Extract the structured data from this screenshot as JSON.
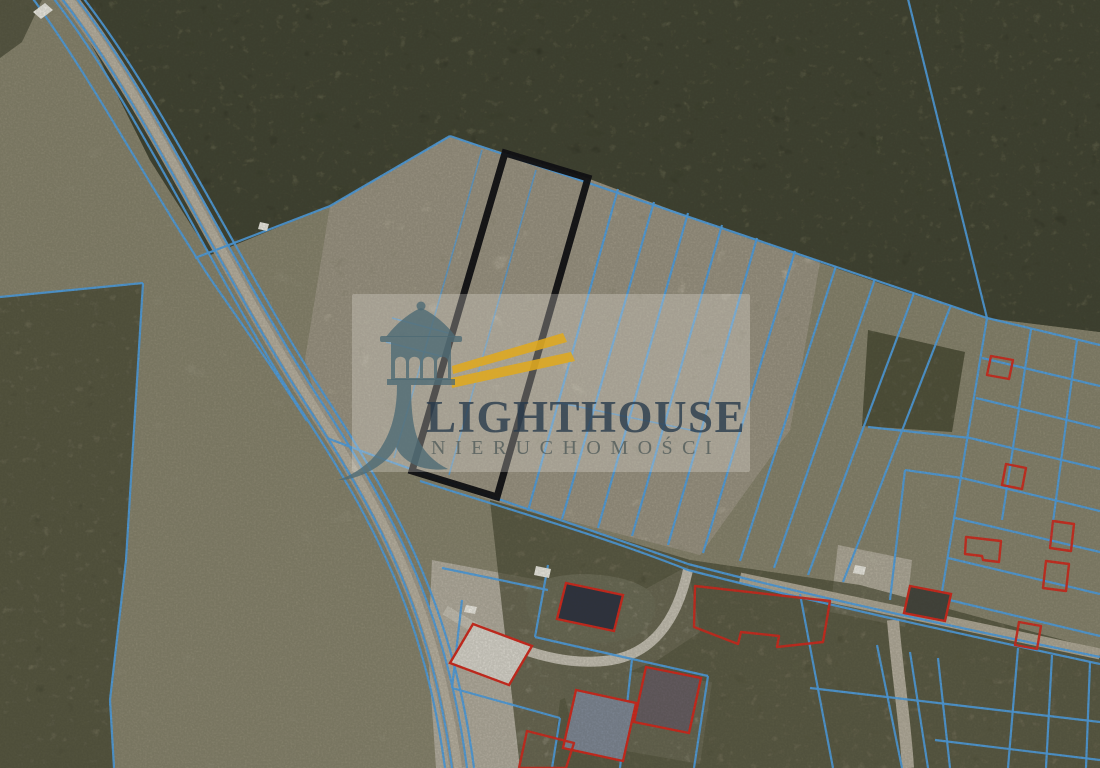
{
  "watermark": {
    "brand": "LIGHTHOUSE",
    "subtitle": "NIERUCHOMOŚCI"
  },
  "colors": {
    "parcel_line": "#4f9fe2",
    "outline_red": "#d2281c",
    "highlight_black": "#0c0c11",
    "vehicle_white": "#eceae2",
    "logo_slate": "#4e6a74",
    "beam_gold": "#dfa81f",
    "brand_text": "rgba(37,56,74,0.78)",
    "subtitle_text": "rgba(86,95,93,0.85)",
    "backdrop": "rgba(238,235,226,0.28)",
    "base_field": "#8f8b75",
    "forest": "#4c4d39",
    "clearing": "#a79f90"
  },
  "map": {
    "highlight_parcel": {
      "d": "M 505,153 L 588,178 L 497,497 L 412,471 Z",
      "stroke_width": 7
    },
    "terrain": [
      {
        "d": "M 0,0 H 1100 V 768 H 0 Z",
        "fill": "#8f8b75"
      },
      {
        "d": "M 330,206 L 450,136 L 505,153 L 587,178 L 730,232 L 820,262 L 790,430 L 700,555 L 490,500 L 412,471 L 327,438 L 305,360 Z",
        "fill": "#a79f90"
      },
      {
        "d": "M 66,0 L 1100,0 L 1100,332 L 987,318 L 900,290 L 730,232 L 587,178 L 505,153 L 450,136 L 330,206 L 210,255 L 150,160 L 100,60 Z",
        "fill": "#4c4d39"
      },
      {
        "d": "M 0,0 L 42,0 L 22,42 L 0,58 Z",
        "fill": "#50513d"
      },
      {
        "d": "M 868,330 L 965,352 L 952,432 L 862,426 Z",
        "fill": "#5a5b45"
      },
      {
        "d": "M 0,297 L 143,283 L 126,560 L 110,700 L 114,768 L 0,768 Z",
        "fill": "#6d6c55"
      },
      {
        "d": "M 490,500 L 690,560 L 860,585 L 1100,650 L 1100,768 L 520,768 Z",
        "fill": "#6f6e58"
      },
      {
        "d": "M 432,560 L 560,584 L 625,600 L 688,566 L 700,632 L 658,660 L 560,700 L 552,768 L 436,768 L 428,650 Z",
        "fill": "#c6c0b4"
      },
      {
        "d": "M 556,662 L 712,682 L 700,764 L 576,742 Z",
        "fill": "#bab5a8"
      },
      {
        "d": "M 838,545 L 912,560 L 905,627 L 830,612 Z",
        "fill": "#c2bcad"
      },
      {
        "d": "M 534,585 C 560,568 625,572 648,590 C 662,602 655,628 630,638 C 600,648 555,644 538,628 C 524,615 522,596 534,585 Z",
        "fill": "#d8d4c9"
      }
    ],
    "texture_overlays": [
      {
        "t": 2,
        "fill": "#262b1a",
        "filter": "blotch-dark",
        "o": 0.8
      },
      {
        "t": 2,
        "fill": "#72745a",
        "filter": "blotch-light",
        "o": 0.5
      },
      {
        "t": 2,
        "fill": "#1c2114",
        "filter": "canopy",
        "o": 0.55
      },
      {
        "t": 4,
        "fill": "#32351f",
        "filter": "canopy",
        "o": 0.45
      },
      {
        "t": 5,
        "fill": "#3a3d2a",
        "filter": "blotch-dark",
        "o": 0.55
      },
      {
        "t": 5,
        "fill": "#8a8668",
        "filter": "blotch-light",
        "o": 0.4
      },
      {
        "t": 5,
        "fill": "#2a2d1e",
        "filter": "canopy",
        "o": 0.4
      },
      {
        "t": 6,
        "fill": "#3f422e",
        "filter": "blotch-dark",
        "o": 0.5
      },
      {
        "t": 6,
        "fill": "#8e8a6e",
        "filter": "blotch-light",
        "o": 0.35
      },
      {
        "t": 6,
        "fill": "#2f321f",
        "filter": "canopy",
        "o": 0.35
      },
      {
        "t": 1,
        "fill": "#c6bfae",
        "filter": "blotch-light",
        "o": 0.55
      },
      {
        "t": 1,
        "fill": "#837c6a",
        "filter": "blotch-dark",
        "o": 0.3
      },
      {
        "t": 0,
        "fill": "#6e6b55",
        "filter": "blotch-dark",
        "o": 0.22
      }
    ],
    "post_overlays": [
      {
        "t": 0,
        "fill": "#2e2e24",
        "filter": "grain",
        "o": 0.16
      }
    ],
    "roads": [
      {
        "d": "M 62,-10 C 150,100 225,270 315,408 C 390,523 438,618 458,768",
        "w": 17,
        "c": "#a29b8c"
      },
      {
        "d": "M 62,-10 C 150,100 225,270 315,408 C 390,523 438,618 458,768",
        "w": 8,
        "c": "#b7b0a0"
      },
      {
        "d": "M 740,578 C 850,602 980,628 1100,654",
        "w": 11,
        "c": "#aea795"
      },
      {
        "d": "M 893,620 C 897,670 905,720 908,768",
        "w": 12,
        "c": "#b3ac9c"
      },
      {
        "d": "M 445,610 C 505,648 560,668 612,660 C 650,653 676,625 688,570",
        "w": 10,
        "c": "#c4bfb2"
      }
    ],
    "cadastral_lines": [
      {
        "d": "M 28,-8 C 92,78 152,192 214,284 C 252,338 282,382 307,421"
      },
      {
        "d": "M 47,-10 C 135,100 210,270 301,410 C 377,525 425,620 445,768"
      },
      {
        "d": "M 55,-10 C 143,100 218,270 309,409 C 384,524 432,619 452,768"
      },
      {
        "d": "M 70,-10 C 158,100 233,269 324,406 C 398,521 447,616 467,768"
      },
      {
        "d": "M 77,-10 C 165,100 240,268 331,405 C 405,520 454,615 474,768"
      },
      {
        "d": "M 195,258 L 330,206 L 450,136"
      },
      {
        "d": "M 450,136 L 987,318"
      },
      {
        "d": "M 907,-5 L 987,318"
      },
      {
        "d": "M 0,297 L 143,283"
      },
      {
        "d": "M 143,283 L 126,560 L 110,700 L 114,768"
      },
      {
        "d": "M 327,438 C 430,478 540,512 688,564 C 810,596 950,626 1100,657"
      },
      {
        "d": "M 420,481 C 520,513 605,537 688,570 C 800,599 952,632 1100,664"
      },
      {
        "d": "M 618,189 L 528,511"
      },
      {
        "d": "M 654,202 L 562,519"
      },
      {
        "d": "M 688,213 L 598,528"
      },
      {
        "d": "M 722,225 L 632,536"
      },
      {
        "d": "M 757,238 L 668,545"
      },
      {
        "d": "M 795,251 L 703,553"
      },
      {
        "d": "M 836,266 L 740,561"
      },
      {
        "d": "M 875,279 L 774,568"
      },
      {
        "d": "M 914,293 L 808,575"
      },
      {
        "d": "M 951,305 L 843,582"
      },
      {
        "d": "M 536,170 L 449,475",
        "w": 1.6,
        "o": 0.75
      },
      {
        "d": "M 482,150 L 394,458",
        "w": 1.6,
        "o": 0.7
      },
      {
        "d": "M 392,318 L 452,334",
        "w": 1.6,
        "o": 0.8
      },
      {
        "d": "M 386,342 L 448,358",
        "w": 1.6,
        "o": 0.8
      },
      {
        "d": "M 556,402 L 700,432",
        "w": 1.6,
        "o": 0.8
      },
      {
        "d": "M 987,318 L 1100,345"
      },
      {
        "d": "M 982,358 L 1100,386"
      },
      {
        "d": "M 976,398 L 1100,428"
      },
      {
        "d": "M 868,427 L 970,438 L 1100,469"
      },
      {
        "d": "M 905,470 L 962,478 L 1100,511"
      },
      {
        "d": "M 955,518 L 1100,552"
      },
      {
        "d": "M 948,558 L 1100,594"
      },
      {
        "d": "M 941,598 L 1100,636"
      },
      {
        "d": "M 987,318 L 941,598"
      },
      {
        "d": "M 1031,329 L 1002,520"
      },
      {
        "d": "M 1077,340 L 1050,545"
      },
      {
        "d": "M 905,470 L 890,600"
      },
      {
        "d": "M 810,688 L 1100,722"
      },
      {
        "d": "M 935,740 L 1100,760"
      },
      {
        "d": "M 877,645 L 902,768"
      },
      {
        "d": "M 910,652 L 928,768"
      },
      {
        "d": "M 938,658 L 950,768"
      },
      {
        "d": "M 1018,648 L 1008,768"
      },
      {
        "d": "M 1052,655 L 1046,768"
      },
      {
        "d": "M 1090,662 L 1086,768"
      },
      {
        "d": "M 800,594 L 833,768"
      },
      {
        "d": "M 442,568 L 548,590"
      },
      {
        "d": "M 548,565 L 535,637"
      },
      {
        "d": "M 535,637 L 632,659"
      },
      {
        "d": "M 632,659 L 620,768"
      },
      {
        "d": "M 632,659 L 708,676"
      },
      {
        "d": "M 708,676 L 694,768"
      },
      {
        "d": "M 462,600 L 452,688"
      },
      {
        "d": "M 452,688 L 560,718"
      },
      {
        "d": "M 560,718 L 552,768"
      }
    ],
    "red_outlines": [
      {
        "d": "M 695,586 L 830,601 L 823,642 L 777,647 L 779,636 L 741,632 L 738,644 L 694,627 Z"
      },
      {
        "d": "M 991,356 L 1013,360 L 1009,379 L 987,375 Z"
      },
      {
        "d": "M 1006,464 L 1026,468 L 1022,489 L 1002,485 Z"
      },
      {
        "d": "M 1053,521 L 1074,524 L 1071,551 L 1050,548 Z"
      },
      {
        "d": "M 966,537 L 1001,541 L 999,562 L 983,560 L 982,556 L 965,554 Z"
      },
      {
        "d": "M 1046,561 L 1069,564 L 1066,591 L 1043,588 Z"
      },
      {
        "d": "M 1019,622 L 1041,626 L 1037,649 L 1015,645 Z"
      },
      {
        "d": "M 527,731 L 574,743 L 566,768 L 519,768 Z"
      }
    ],
    "buildings": [
      {
        "d": "M 566,583 L 623,595 L 614,631 L 557,619 Z",
        "fill": "#2e3340"
      },
      {
        "d": "M 473,624 L 532,646 L 509,685 L 450,663 Z",
        "fill": "#d8d5cc"
      },
      {
        "d": "M 576,690 L 636,703 L 623,761 L 563,748 Z",
        "fill": "#7e8795"
      },
      {
        "d": "M 646,667 L 701,678 L 689,733 L 634,722 Z",
        "fill": "#655c61"
      },
      {
        "d": "M 910,586 L 951,594 L 945,621 L 904,613 Z",
        "fill": "#43443c"
      }
    ],
    "white_objects": [
      {
        "d": "M 33,12 L 45,3 L 53,10 L 41,19 Z"
      },
      {
        "d": "M 260,222 L 269,224 L 267,231 L 258,229 Z"
      },
      {
        "d": "M 536,566 L 551,569 L 549,578 L 534,575 Z"
      },
      {
        "d": "M 466,605 L 477,607 L 475,614 L 464,612 Z"
      },
      {
        "d": "M 855,565 L 866,567 L 864,575 L 853,573 Z"
      }
    ]
  }
}
